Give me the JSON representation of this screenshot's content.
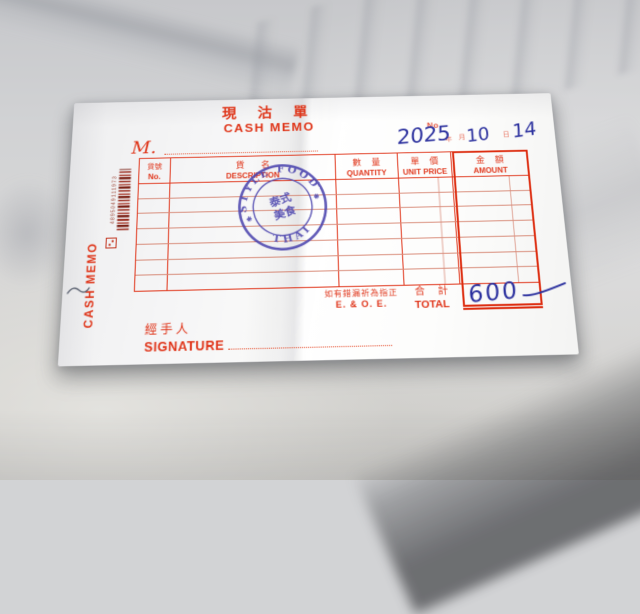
{
  "receipt": {
    "title": {
      "zh": "現 沽 單",
      "en": "CASH MEMO"
    },
    "no_label": "No.",
    "customer_prefix": "M.",
    "date_line": {
      "year": "2025",
      "year_label": "年",
      "month": "10",
      "month_label": "月",
      "day": "14",
      "day_label": "日"
    },
    "columns": [
      {
        "zh": "貨號",
        "en": "No."
      },
      {
        "zh": "貨　名",
        "en": "DESCRIPTION"
      },
      {
        "zh": "數 量",
        "en": "QUANTITY"
      },
      {
        "zh": "單 價",
        "en": "UNIT PRICE"
      },
      {
        "zh": "金 額",
        "en": "AMOUNT"
      }
    ],
    "blank_body_rows": 7,
    "total": {
      "zh": "合 計",
      "en": "TOTAL",
      "value": "600"
    },
    "eoe": {
      "zh": "如有錯漏祈為指正",
      "en": "E. & O. E."
    },
    "signature": {
      "zh": "經手人",
      "en": "SIGNATURE"
    },
    "edge": {
      "vertical_label": "CASH MEMO",
      "barcode_digits": "4895049111973"
    },
    "stamp": {
      "arc_top": "STYLE FOOD",
      "arc_bottom": "THAI",
      "center_line1": "泰式",
      "center_line2": "美食"
    },
    "colors": {
      "print_red": "#e0391e",
      "ink_blue": "#2b309e",
      "stamp_blue": "#4a43ae"
    }
  }
}
